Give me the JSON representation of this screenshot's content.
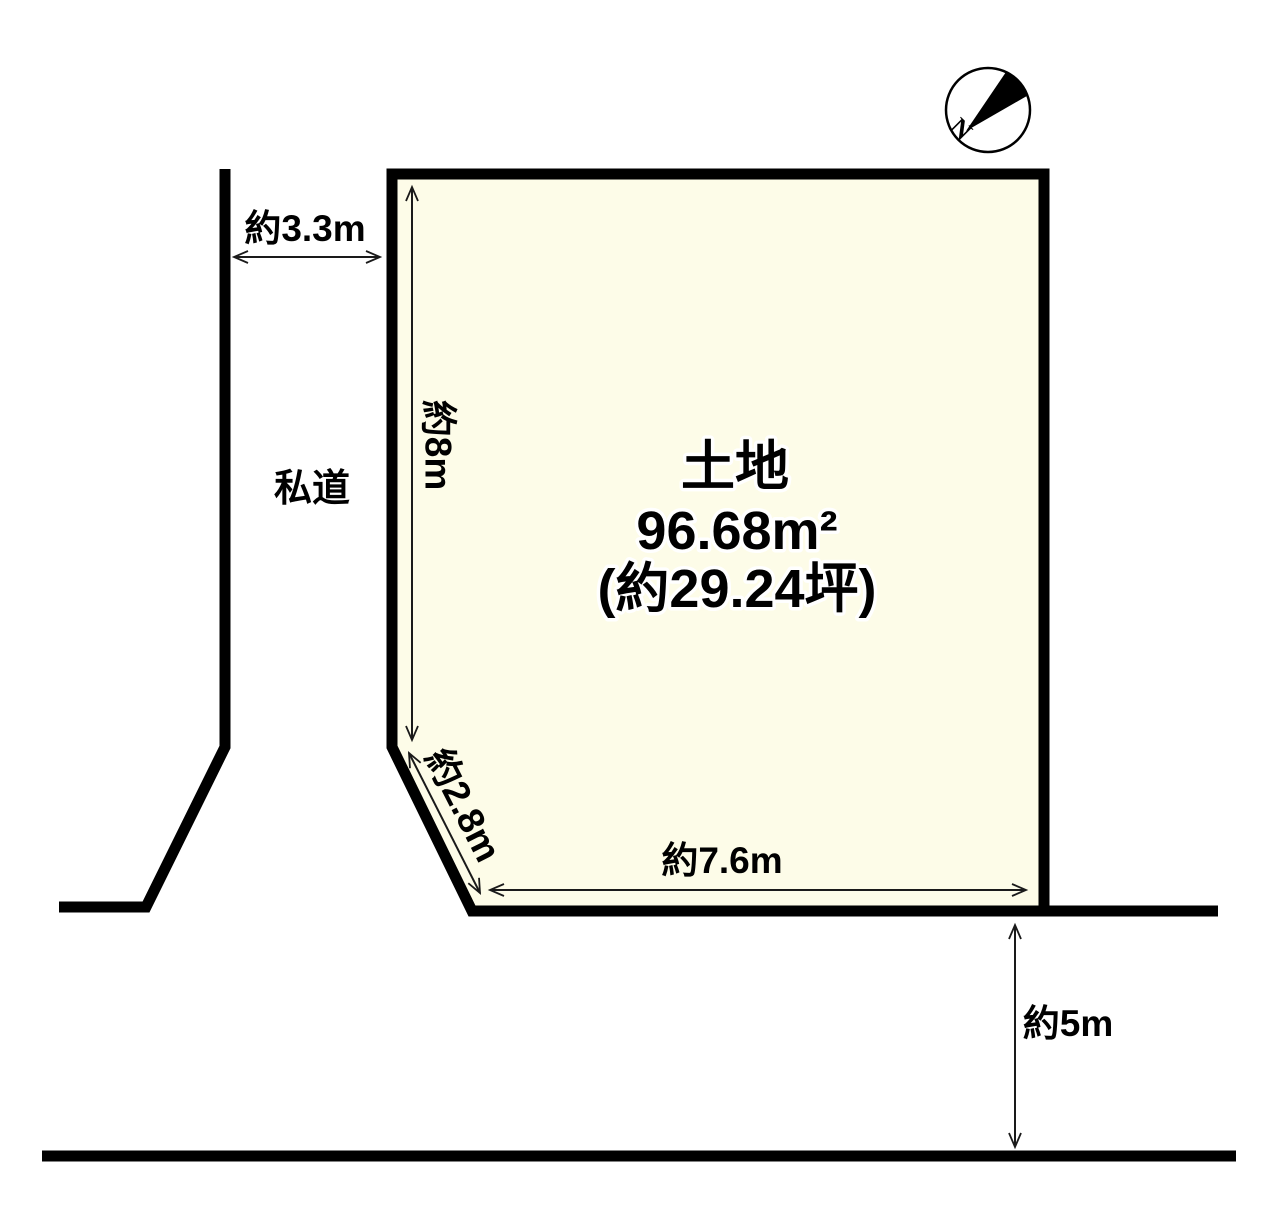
{
  "figure": {
    "type": "land-plot-diagram",
    "compass": {
      "north_label": "N"
    },
    "plot": {
      "name": "土地",
      "area_sqm": "96.68m²",
      "area_tsubo": "(約29.24坪)"
    },
    "labels": {
      "private_road": "私道"
    },
    "dimensions": {
      "front_road_width": "約3.3m",
      "west_side": "約8m",
      "chamfer": "約2.8m",
      "south_side": "約7.6m",
      "south_road_width": "約5m"
    },
    "colors": {
      "plot_fill": "#FDFCE8",
      "outline": "#000000"
    }
  }
}
